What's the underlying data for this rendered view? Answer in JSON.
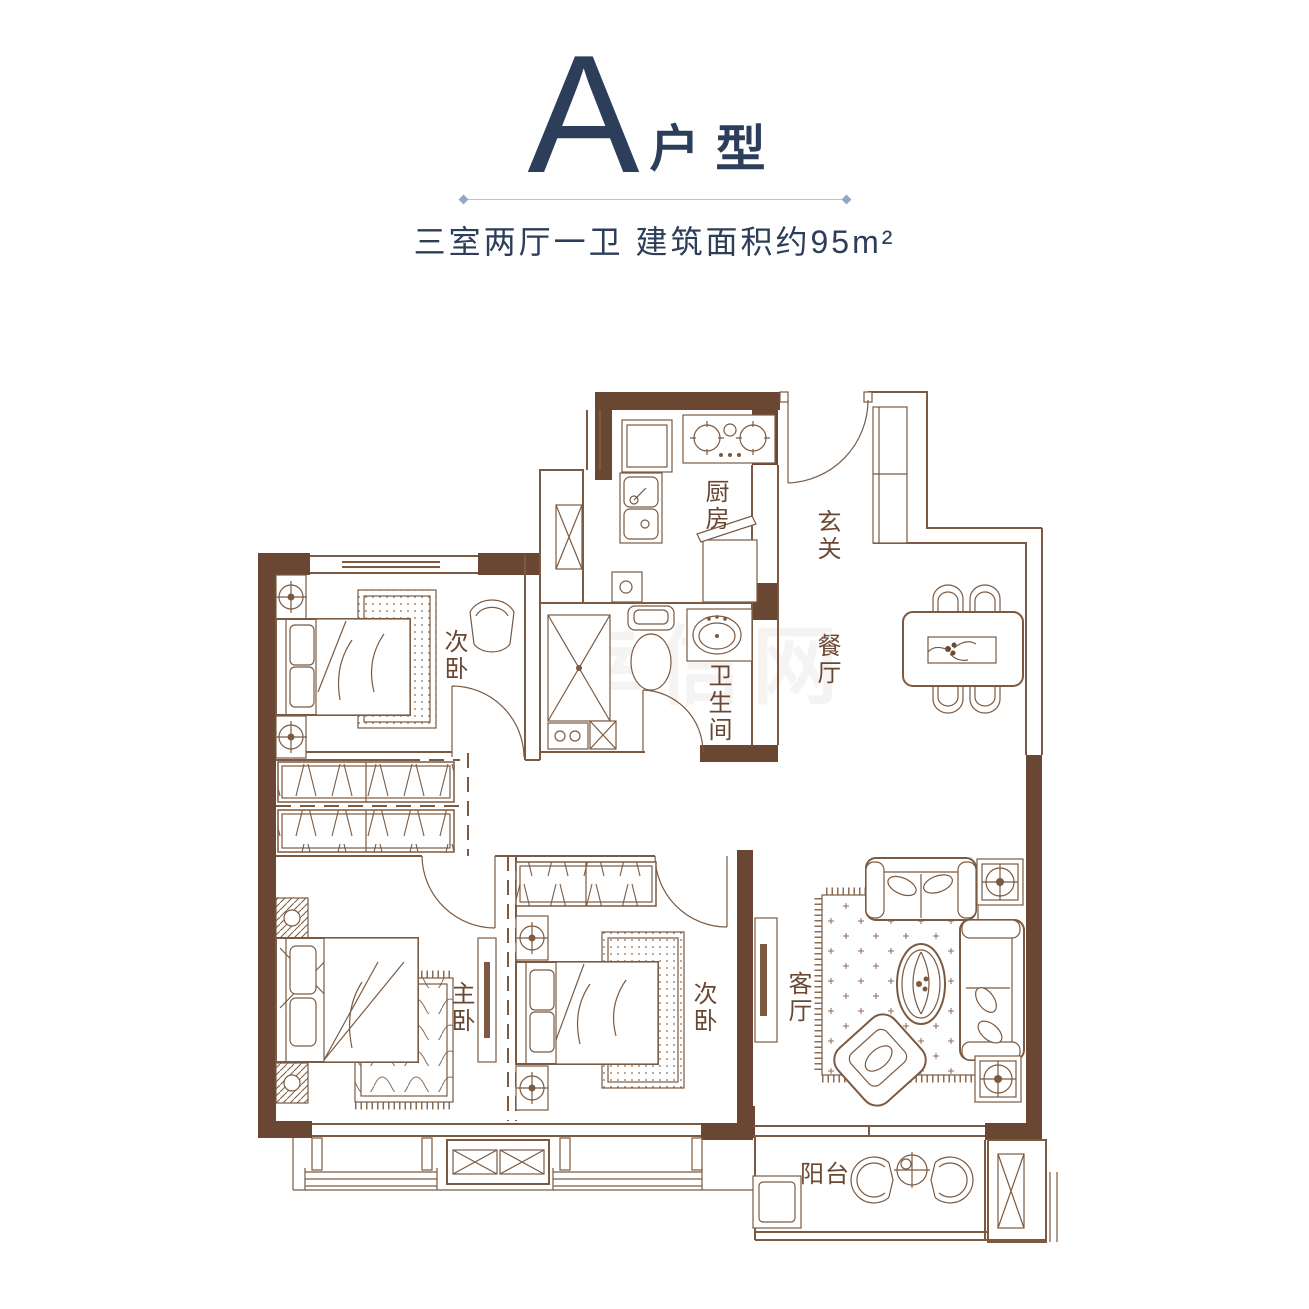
{
  "header": {
    "plan_letter": "A",
    "plan_suffix": "户型",
    "subtitle": "三室两厅一卫  建筑面积约95m²",
    "title_color": "#2d3e5a"
  },
  "floorplan": {
    "wall_color": "#6a4733",
    "line_color": "#7b5a41",
    "rooms": {
      "kitchen": "厨房",
      "entry": "玄关",
      "dining": "餐厅",
      "bedroom_top": "次卧",
      "bathroom": "卫生间",
      "master": "主卧",
      "bedroom_bottom": "次卧",
      "living": "客厅",
      "balcony": "阳台"
    },
    "watermark": "幸信网"
  }
}
